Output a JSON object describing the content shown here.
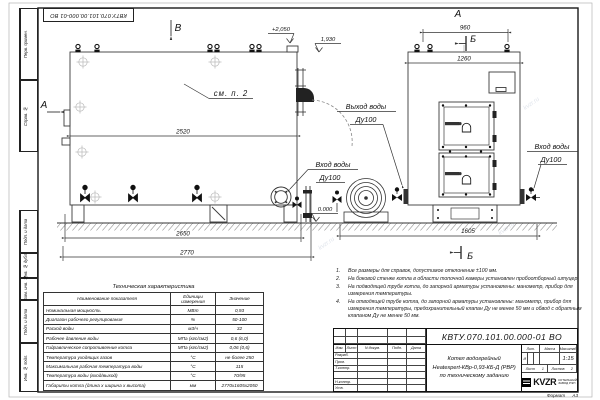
{
  "doc": {
    "number": "КВТУ.070.101.00.000-01 ВО",
    "format_label": "Формат",
    "format_value": "А3"
  },
  "margin": {
    "top": [
      "Перв. примен.",
      "Справ. №"
    ],
    "bottom": [
      "Подп. и дата",
      "Инв. № дубл.",
      "Взам. инв. №",
      "Подп. и дата",
      "Инв. № подл."
    ]
  },
  "drawing": {
    "view_b": "В",
    "view_a_side": "А",
    "view_a_front": "А",
    "section_b_top": "Б",
    "section_b_bottom": "Б",
    "see_note": "см. п. 2",
    "elev_top": "+2,050",
    "elev_outlet": "1,930",
    "elev_zero": "0.000",
    "dim_2520": "2520",
    "dim_2650": "2650",
    "dim_2770": "2770",
    "dim_960": "960",
    "dim_1260": "1260",
    "dim_1605": "1605",
    "outlet_line1": "Выход воды",
    "outlet_line2": "Ду100",
    "inlet_side_line1": "Вход воды",
    "inlet_side_line2": "Ду100",
    "inlet_front_line1": "Вход воды",
    "inlet_front_line2": "Ду100",
    "watermark": "kvzr.ru"
  },
  "notes": {
    "items": [
      {
        "num": "1.",
        "text": "Все размеры для справок, допустимое отклонение ±100 мм."
      },
      {
        "num": "2.",
        "text": "На боковой стенке котла в области топочной камеры установлен пробоотборный штуцер"
      },
      {
        "num": "3.",
        "text": "На подводящей трубе котла, до запорной арматуры установлены: манометр, прибор для измерения температуры."
      },
      {
        "num": "4.",
        "text": "На отводящей трубе котла, до запорной арматуры установлены: манометр, прибор для измерения температуры, предохранительный клапан Ду не менее 50 мм и обвод с обратным клапаном Ду не менее 50 мм."
      }
    ]
  },
  "tech_table": {
    "title": "Техническая характеристика",
    "headers": [
      "Наименование показателя",
      "Единицы измерения",
      "Значение"
    ],
    "rows": [
      [
        "Номинальная мощность",
        "МВт",
        "0,93"
      ],
      [
        "Диапазон рабочего регулирования",
        "%",
        "50-100"
      ],
      [
        "Расход воды",
        "м3/ч",
        "32"
      ],
      [
        "Рабочее давление воды",
        "МПа (кгс/см2)",
        "0,6 (6,0)"
      ],
      [
        "Гидравлическое сопротивление котла",
        "МПа (кгс/см2)",
        "0,06 (0,6)"
      ],
      [
        "Температура уходящих газов",
        "°С",
        "не более 250"
      ],
      [
        "Максимальная рабочая температура воды",
        "°С",
        "115"
      ],
      [
        "Температура воды (вход/выход)",
        "°С",
        "70/95"
      ],
      [
        "Габариты котла (длина х ширина х высота)",
        "мм",
        "2770х1605х2050"
      ]
    ]
  },
  "title_block": {
    "number": "КВТУ.070.101.00.000-01 ВО",
    "name_line1": "Котел водогрейный",
    "name_line2": "Heatexpert-КВр-0,93-КБ-Д (РВР)",
    "name_line3": "по техническому заданию",
    "header": [
      "Изм.",
      "Лист",
      "N докум.",
      "Подп.",
      "Дата"
    ],
    "roles": [
      "Разраб.",
      "Пров.",
      "Т.контр.",
      "Н.контр.",
      "Утв."
    ],
    "lit_label": "Лит.",
    "lit_value": "И",
    "mass_label": "Масса",
    "scale_label": "Масштаб",
    "scale_value": "1:15",
    "sheet_label": "Лист",
    "sheet_value": "1",
    "sheets_label": "Листов",
    "sheets_value": "2",
    "logo": "KVZR",
    "logo_sub1": "КОТЕЛЬНЫЙ",
    "logo_sub2": "ЗАВОД РЭП"
  }
}
